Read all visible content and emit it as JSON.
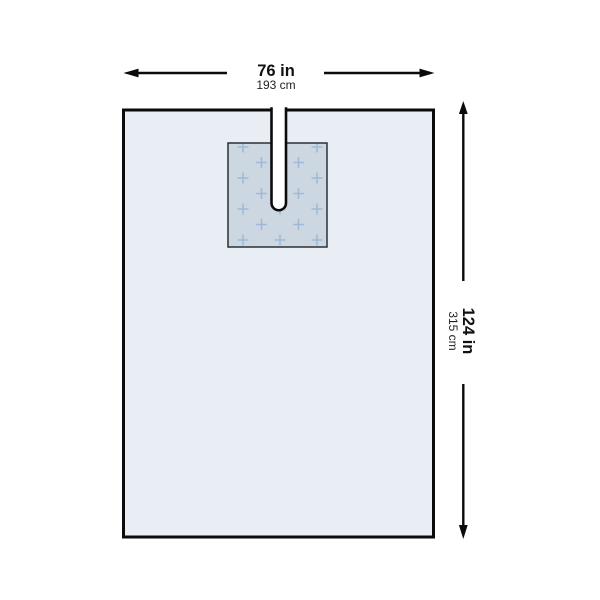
{
  "diagram": {
    "type": "product-dimension-diagram",
    "subject": "surgical-drape-with-reinforced-panel-and-u-slot",
    "width_label": {
      "primary": "76 in",
      "secondary": "193 cm"
    },
    "height_label": {
      "primary": "124 in",
      "secondary": "315 cm"
    },
    "colors": {
      "background": "#ffffff",
      "drape_fill": "#e9edf4",
      "drape_border": "#0b0b0b",
      "panel_fill": "#cdd7e2",
      "panel_border": "#2a3036",
      "cross_marks": "#9fbad8",
      "slot_fill": "#ffffff",
      "dimension_lines": "#0b0b0b",
      "label_primary": "#111111",
      "label_secondary": "#222222"
    }
  }
}
